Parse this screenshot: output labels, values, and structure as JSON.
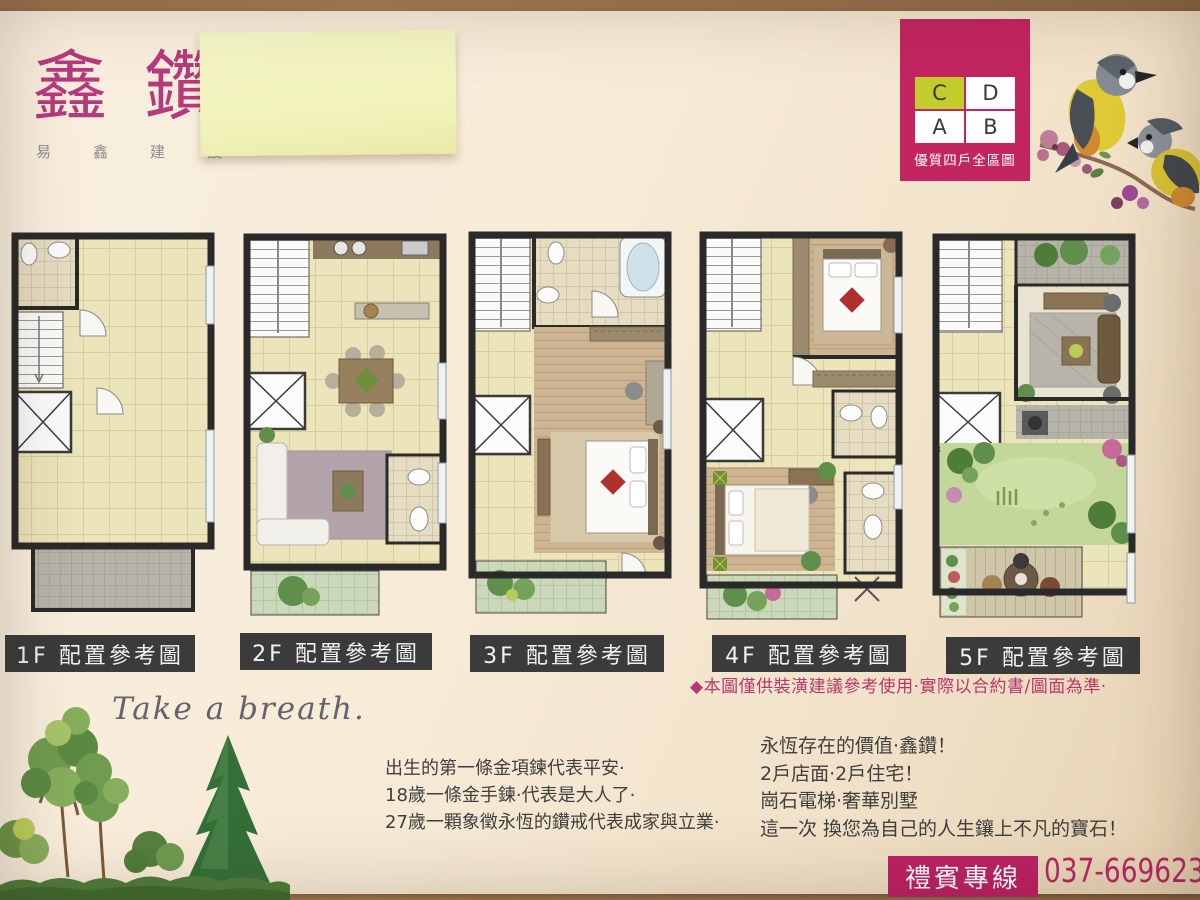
{
  "logo": {
    "title": "鑫鑽",
    "subtitle": "易鑫建設"
  },
  "unit_box": {
    "cells": [
      {
        "label": "C",
        "highlighted": true
      },
      {
        "label": "D",
        "highlighted": false
      },
      {
        "label": "A",
        "highlighted": false
      },
      {
        "label": "B",
        "highlighted": false
      }
    ],
    "caption": "優質四戶全區圖"
  },
  "plans": [
    {
      "label": "1F 配置參考圖"
    },
    {
      "label": "2F 配置參考圖"
    },
    {
      "label": "3F 配置參考圖"
    },
    {
      "label": "4F 配置參考圖"
    },
    {
      "label": "5F 配置參考圖"
    }
  ],
  "disclaimer": "◆本圖僅供裝潢建議參考使用·實際以合約書/圖面為準·",
  "tagline": "Take a breath.",
  "story_lines": [
    "出生的第一條金項鍊代表平安·",
    "18歲一條金手鍊·代表是大人了·",
    "27歲一顆象徵永恆的鑽戒代表成家與立業·"
  ],
  "pitch_lines": [
    "永恆存在的價值·鑫鑽！",
    "2戶店面·2戶住宅！",
    "崗石電梯·奢華別墅",
    "這一次 換您為自己的人生鑲上不凡的寶石！"
  ],
  "hotline": {
    "label": "禮賓專線",
    "phone": "037-669623"
  },
  "colors": {
    "accent": "#c22560",
    "highlight_cell": "#c2cc2b",
    "label_bg": "#3b3b3b",
    "disclaimer": "#b5386e",
    "sticky_note": "#f1f2b9"
  }
}
